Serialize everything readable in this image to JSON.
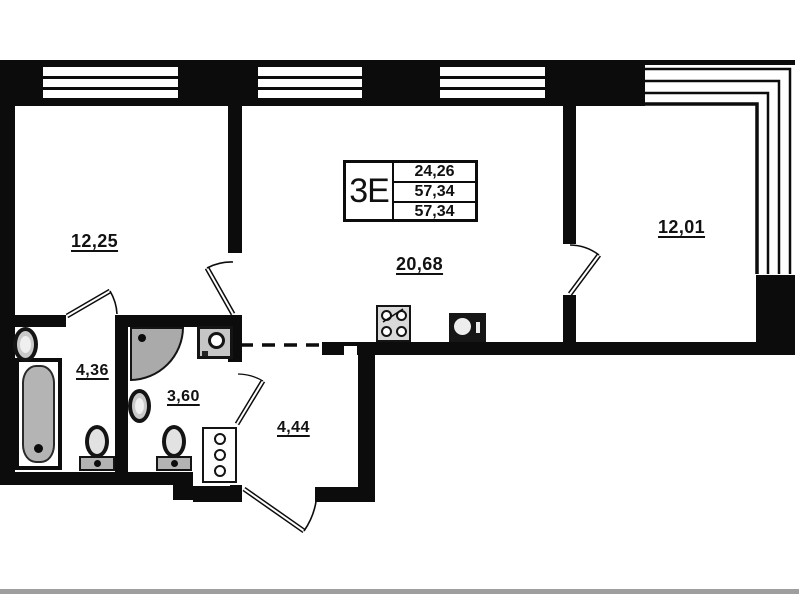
{
  "plan": {
    "unit_label": "3Е",
    "info_box": {
      "living_area": "24,26",
      "total_area": "57,34",
      "total_area_with_balcony": "57,34"
    },
    "rooms": [
      {
        "id": "bedroom-left",
        "area": "12,25"
      },
      {
        "id": "kitchen-living",
        "area": "20,68"
      },
      {
        "id": "bedroom-right",
        "area": "12,01"
      },
      {
        "id": "bathroom",
        "area": "4,36"
      },
      {
        "id": "shower-room",
        "area": "3,60"
      },
      {
        "id": "hallway",
        "area": "4,44"
      }
    ],
    "fixtures": [
      "bathtub",
      "sink",
      "toilet",
      "shower",
      "washing-machine",
      "sink",
      "toilet",
      "utility-riser",
      "stove",
      "kitchen-sink"
    ],
    "colors": {
      "wall": "#0c0c0c",
      "fixture_fill": "#b4b4b4",
      "background": "#ffffff"
    }
  }
}
